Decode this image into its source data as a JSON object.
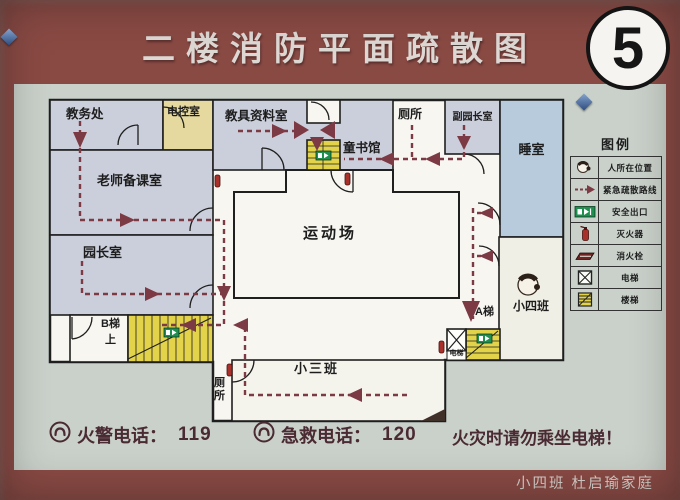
{
  "title": "二楼消防平面疏散图",
  "badge": "5",
  "plan": {
    "rooms": {
      "jiaowuchu": "教务处",
      "diankongshi": "电控室",
      "jiaojuziliaoshi": "教具资料室",
      "cesuo_top": "厕所",
      "fuyuanzhangshi": "副园长室",
      "shuishi": "睡室",
      "laoshibeikeshi": "老师备课室",
      "tongshuguan": "童书馆",
      "yundongchang": "运动场",
      "yuanzhangshi": "园长室",
      "xiaosiban": "小四班",
      "xiaosanban": "小三班",
      "cesuo_bottom": "厕所",
      "b_stairs": "B梯",
      "b_stairs_dir": "上",
      "a_stairs": "A梯",
      "dianti": "电梯"
    }
  },
  "legend": {
    "title": "图例",
    "items": [
      {
        "icon": "person-icon",
        "label": "人所在位置"
      },
      {
        "icon": "route-icon",
        "label": "紧急疏散路线"
      },
      {
        "icon": "exit-icon",
        "label": "安全出口"
      },
      {
        "icon": "extinguisher-icon",
        "label": "灭火器"
      },
      {
        "icon": "hydrant-icon",
        "label": "消火栓"
      },
      {
        "icon": "elevator-icon",
        "label": "电梯"
      },
      {
        "icon": "stairs-icon",
        "label": "楼梯"
      }
    ]
  },
  "footer": {
    "fire_phone_label": "火警电话：",
    "fire_phone_number": "119",
    "ems_phone_label": "急救电话：",
    "ems_phone_number": "120",
    "warning": "火灾时请勿乘坐电梯！",
    "signature": "小四班  杜启瑜家庭"
  },
  "colors": {
    "frame": "#8a4a44",
    "panel": "#c9d1ca",
    "route": "#7c3a44",
    "room": "#cbcfdb",
    "room_yellow": "#e6d9a0",
    "room_blue": "#b7cbdd",
    "stairs_yellow": "#e2d34b",
    "exit_green": "#1e8f4e"
  }
}
